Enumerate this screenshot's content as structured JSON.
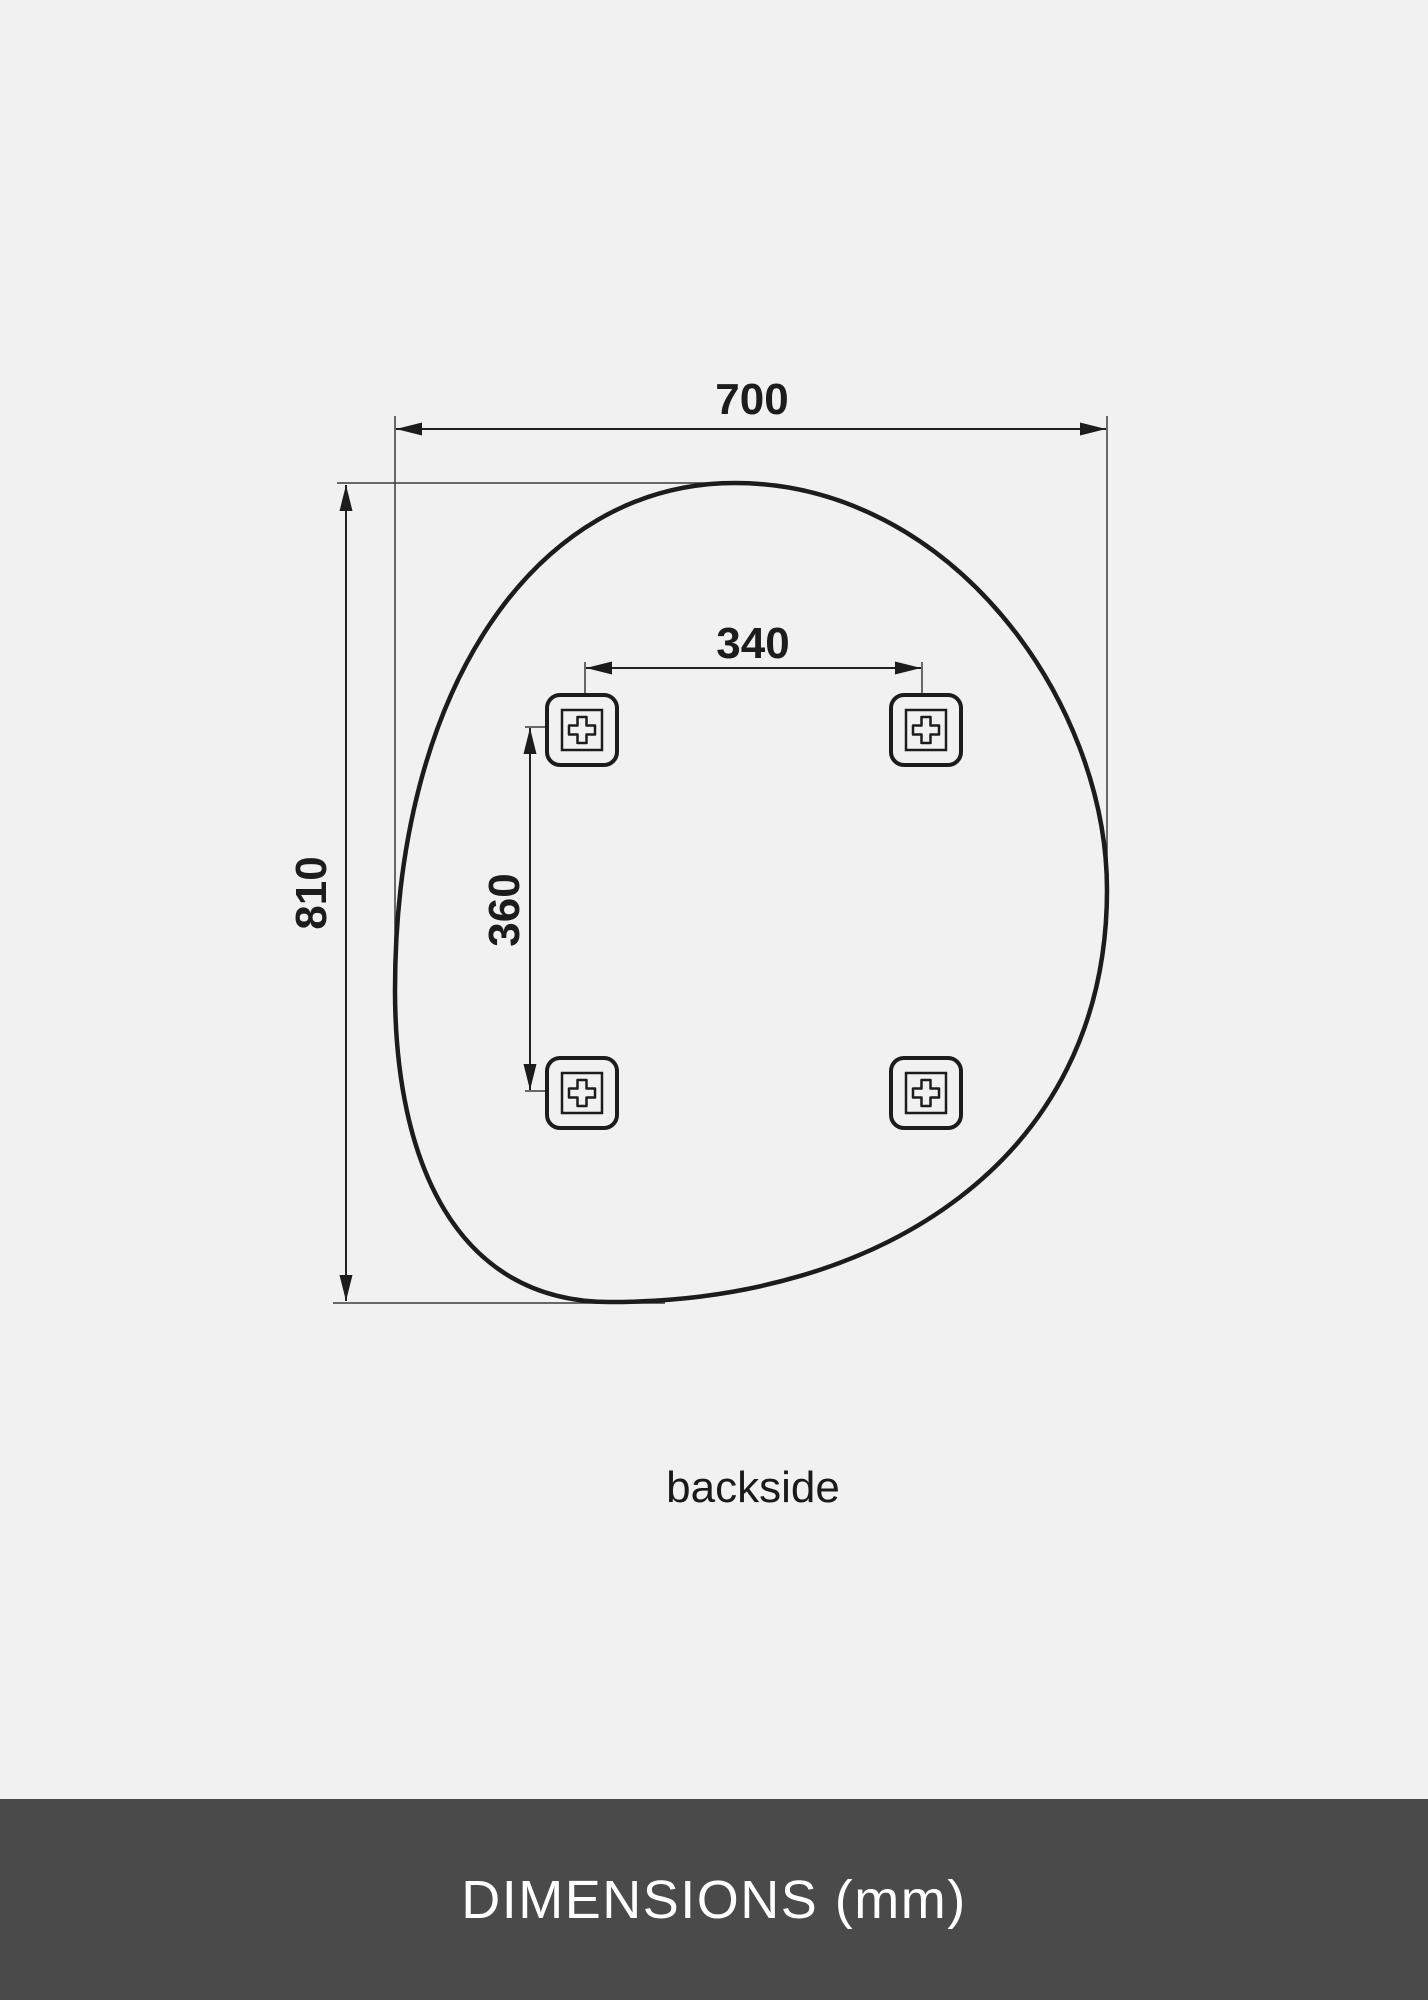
{
  "page": {
    "background_color": "#f1f1f1",
    "line_color": "#1c1c1c"
  },
  "diagram": {
    "view_label": "backside",
    "dimensions": {
      "width_mm": "700",
      "height_mm": "810",
      "bracket_spacing_horizontal_mm": "340",
      "bracket_spacing_vertical_mm": "360"
    },
    "brackets": {
      "count": 4,
      "icon": "plus-icon"
    }
  },
  "footer": {
    "title": "DIMENSIONS (mm)",
    "background_color": "#4a4a4a",
    "text_color": "#ffffff"
  }
}
